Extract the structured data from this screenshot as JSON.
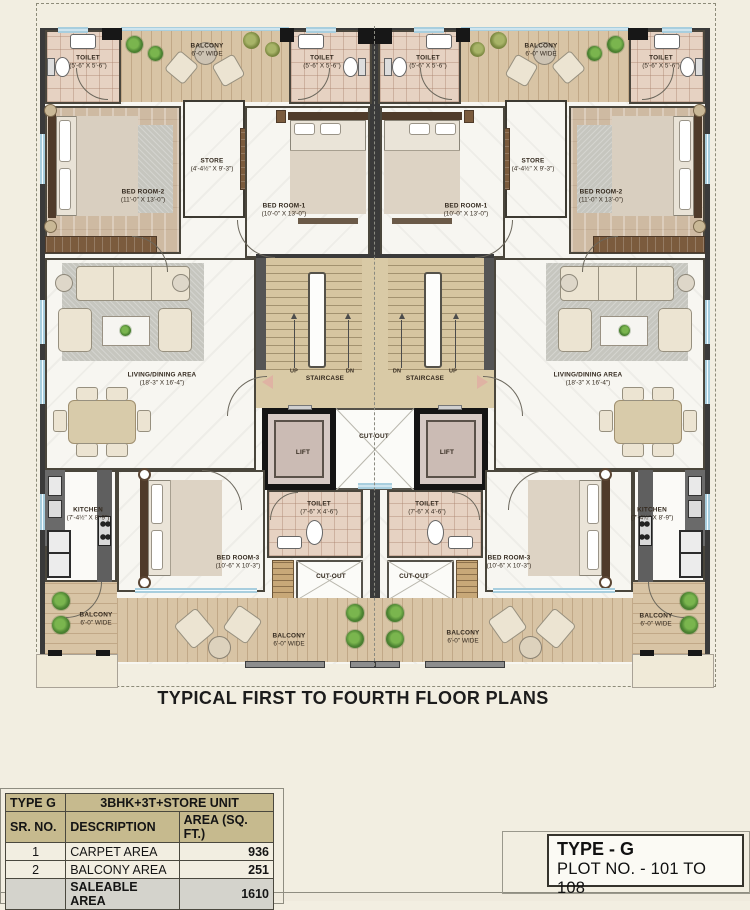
{
  "page": {
    "bg": "#f2eee1",
    "accent_tan": "#c6ba8e",
    "wall_color": "#3a3a3a",
    "window_blue": "#a8cede",
    "deck_wood": "#d8c4a5"
  },
  "title": "TYPICAL FIRST TO FOURTH FLOOR PLANS",
  "plan": {
    "labels": [
      {
        "n": "toilet-top-left",
        "t": "TOILET",
        "d": "(5'-6\" X 5'-6\")",
        "x": 88,
        "y": 62
      },
      {
        "n": "balcony-top-left",
        "t": "BALCONY",
        "d": "6'-0\" WIDE",
        "x": 207,
        "y": 50
      },
      {
        "n": "toilet-top-center-left",
        "t": "TOILET",
        "d": "(5'-6\" X 5'-6\")",
        "x": 322,
        "y": 62
      },
      {
        "n": "toilet-top-center-right",
        "t": "TOILET",
        "d": "(5'-6\" X 5'-6\")",
        "x": 428,
        "y": 62
      },
      {
        "n": "balcony-top-right",
        "t": "BALCONY",
        "d": "6'-0\" WIDE",
        "x": 541,
        "y": 50
      },
      {
        "n": "toilet-top-right",
        "t": "TOILET",
        "d": "(5'-6\" X 5'-6\")",
        "x": 661,
        "y": 62
      },
      {
        "n": "bedroom2-left",
        "t": "BED ROOM-2",
        "d": "(11'-0\" X 13'-0\")",
        "x": 143,
        "y": 196
      },
      {
        "n": "store-left",
        "t": "STORE",
        "d": "(4'-4½\" X 9'-3\")",
        "x": 212,
        "y": 165
      },
      {
        "n": "bedroom1-left",
        "t": "BED ROOM-1",
        "d": "(10'-0\" X 13'-0\")",
        "x": 284,
        "y": 210
      },
      {
        "n": "bedroom1-right",
        "t": "BED ROOM-1",
        "d": "(10'-0\" X 13'-0\")",
        "x": 466,
        "y": 210
      },
      {
        "n": "store-right",
        "t": "STORE",
        "d": "(4'-4½\" X 9'-3\")",
        "x": 533,
        "y": 165
      },
      {
        "n": "bedroom2-right",
        "t": "BED ROOM-2",
        "d": "(11'-0\" X 13'-0\")",
        "x": 601,
        "y": 196
      },
      {
        "n": "living-dining-left",
        "t": "LIVING/DINING AREA",
        "d": "(18'-3\" X 16'-4\")",
        "x": 162,
        "y": 379
      },
      {
        "n": "living-dining-right",
        "t": "LIVING/DINING AREA",
        "d": "(18'-3\" X 16'-4\")",
        "x": 588,
        "y": 379
      },
      {
        "n": "up-left",
        "t": "UP",
        "x": 294,
        "y": 372,
        "fs": 5.5
      },
      {
        "n": "staircase-left",
        "t": "STAIRCASE",
        "x": 325,
        "y": 379
      },
      {
        "n": "dn-left",
        "t": "DN",
        "x": 350,
        "y": 372,
        "fs": 5.5
      },
      {
        "n": "dn-right",
        "t": "DN",
        "x": 397,
        "y": 372,
        "fs": 5.5
      },
      {
        "n": "staircase-right",
        "t": "STAIRCASE",
        "x": 425,
        "y": 379
      },
      {
        "n": "up-right",
        "t": "UP",
        "x": 453,
        "y": 372,
        "fs": 5.5
      },
      {
        "n": "cutout-middle",
        "t": "CUT-OUT",
        "x": 374,
        "y": 437
      },
      {
        "n": "lift-left",
        "t": "LIFT",
        "x": 303,
        "y": 453
      },
      {
        "n": "lift-right",
        "t": "LIFT",
        "x": 447,
        "y": 453
      },
      {
        "n": "kitchen-left",
        "t": "KITCHEN",
        "d": "(7'-4½\" X 8'-9\")",
        "x": 88,
        "y": 514
      },
      {
        "n": "bedroom3-left",
        "t": "BED ROOM-3",
        "d": "(10'-6\" X 10'-3\")",
        "x": 238,
        "y": 562
      },
      {
        "n": "toilet-bottom-left",
        "t": "TOILET",
        "d": "(7'-6\" X 4'-6\")",
        "x": 319,
        "y": 508
      },
      {
        "n": "toilet-bottom-right",
        "t": "TOILET",
        "d": "(7'-6\" X 4'-6\")",
        "x": 427,
        "y": 508
      },
      {
        "n": "bedroom3-right",
        "t": "BED ROOM-3",
        "d": "(10'-6\" X 10'-3\")",
        "x": 509,
        "y": 562
      },
      {
        "n": "kitchen-right",
        "t": "KITCHEN",
        "d": "(7'-4½\" X 8'-9\")",
        "x": 652,
        "y": 514
      },
      {
        "n": "cutout-bottom-left",
        "t": "CUT-OUT",
        "x": 331,
        "y": 577
      },
      {
        "n": "cutout-bottom-right",
        "t": "CUT-OUT",
        "x": 414,
        "y": 577
      },
      {
        "n": "balcony-left-side",
        "t": "BALCONY",
        "d": "6'-0\" WIDE",
        "x": 96,
        "y": 619
      },
      {
        "n": "balcony-bottom-left",
        "t": "BALCONY",
        "d": "6'-0\" WIDE",
        "x": 289,
        "y": 640
      },
      {
        "n": "balcony-bottom-right",
        "t": "BALCONY",
        "d": "6'-0\" WIDE",
        "x": 463,
        "y": 637
      },
      {
        "n": "balcony-right-side",
        "t": "BALCONY",
        "d": "6'-0\" WIDE",
        "x": 656,
        "y": 620
      }
    ]
  },
  "area_table": {
    "type_label": "TYPE G",
    "unit_label": "3BHK+3T+STORE UNIT",
    "headers": [
      "SR. NO.",
      "DESCRIPTION",
      "AREA (SQ. FT.)"
    ],
    "rows": [
      {
        "sr": "1",
        "desc": "CARPET AREA",
        "area": "936"
      },
      {
        "sr": "2",
        "desc": "BALCONY AREA",
        "area": "251"
      }
    ],
    "footer": {
      "label": "SALEABLE AREA",
      "value": "1610"
    }
  },
  "type_box": {
    "line1": "TYPE - G",
    "line2": "PLOT NO. - 101 TO 108"
  }
}
